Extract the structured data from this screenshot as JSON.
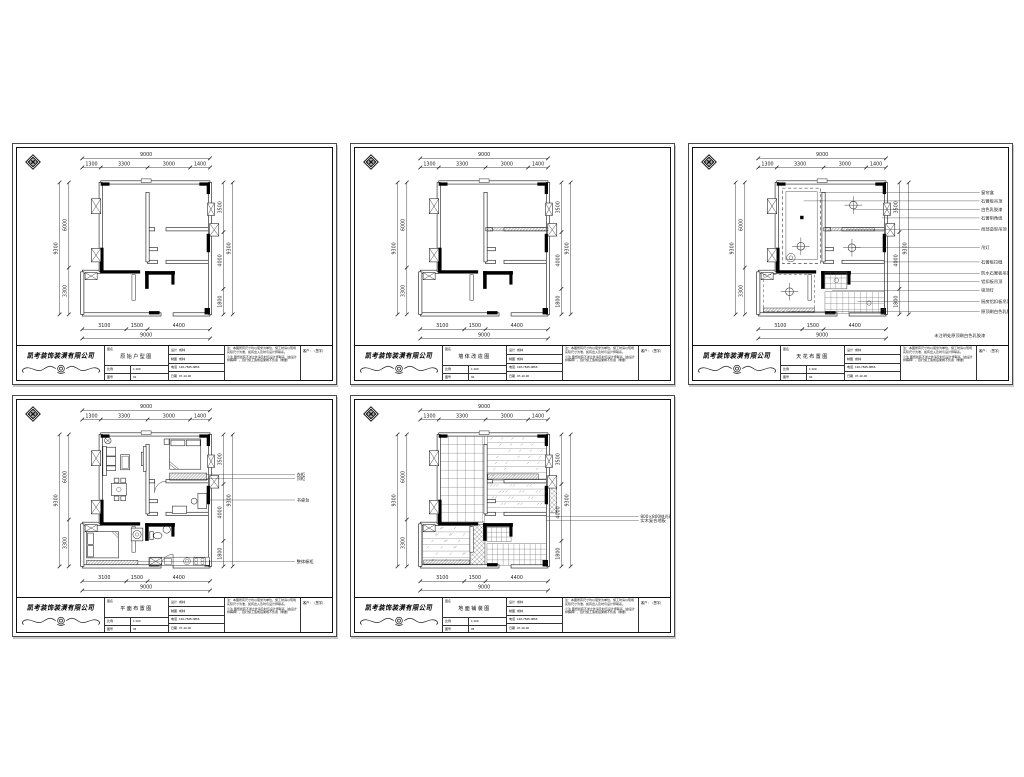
{
  "page": {
    "background": "#ffffff",
    "sheet_count": 5
  },
  "company": {
    "name": "凯考装饰装潢有限公司"
  },
  "sheet_titles": [
    "原始户型图",
    "墙体改造图",
    "天花布置图",
    "平面布置图",
    "地面铺装图"
  ],
  "title_block": {
    "drawing_label": "图名",
    "scale_label": "比例",
    "scale_value": "1:100",
    "no_label": "图号",
    "no_values": [
      "01",
      "02",
      "03",
      "04",
      "05"
    ],
    "fields": [
      {
        "label": "设计",
        "value": "成林"
      },
      {
        "label": "制图",
        "value": "成林"
      },
      {
        "label": "电话",
        "value": "130-7845-0866"
      },
      {
        "label": "日期",
        "value": "07-10-30"
      }
    ],
    "notes": [
      "注：本图所有尺寸均以毫米为单位，施工时请以现场实际尺寸为准，如有出入及时与设计师联系。",
      "※注 图纸如有不详之处请及时与设计师联系（由设计师解释），自行施工造成后果概不负责（重要）"
    ],
    "sign_label": "客户：（签字）"
  },
  "plan_dims": {
    "top": {
      "total": "9000",
      "segs": [
        [
          "1300",
          0,
          1300
        ],
        [
          "3300",
          1300,
          4600
        ],
        [
          "3000",
          4600,
          7600
        ],
        [
          "1400",
          7600,
          9000
        ]
      ]
    },
    "bottom": {
      "total": "9000",
      "segs": [
        [
          "3100",
          0,
          3100
        ],
        [
          "1500",
          3100,
          4600
        ],
        [
          "4400",
          4600,
          9000
        ]
      ]
    },
    "left": {
      "total": "9300",
      "segs": [
        [
          "6000",
          0,
          6000
        ],
        [
          "3300",
          6000,
          9300
        ]
      ]
    },
    "right": {
      "total": "9300",
      "segs": [
        [
          "3500",
          0,
          3500
        ],
        [
          "4000",
          3500,
          7500
        ],
        [
          "1800",
          7500,
          9300
        ]
      ]
    }
  },
  "leaders": {
    "ceiling": [
      [
        4300,
        700,
        "窗帘盒"
      ],
      [
        3200,
        1300,
        "石膏板吊顶"
      ],
      [
        6700,
        1900,
        "白色乳胶漆"
      ],
      [
        8700,
        2500,
        "石膏阴角线"
      ],
      [
        6200,
        3300,
        "局部造型吊顶"
      ],
      [
        6600,
        4600,
        "吊灯"
      ],
      [
        8800,
        5600,
        "石膏板拉缝"
      ],
      [
        5500,
        6400,
        "防水石膏板吊顶"
      ],
      [
        6300,
        7000,
        "铝扣板吊顶"
      ],
      [
        5200,
        7600,
        "吸顶灯"
      ],
      [
        7000,
        8400,
        "厨房铝扣板吊顶"
      ],
      [
        2200,
        9100,
        "原顶刷白色乳胶漆"
      ]
    ],
    "furniture": [
      [
        8700,
        2820,
        "衣柜"
      ],
      [
        8700,
        3120,
        "顶柜"
      ],
      [
        8900,
        4620,
        "书桌台"
      ],
      [
        3900,
        8950,
        "整体橱柜"
      ]
    ],
    "floor": [
      [
        8900,
        5780,
        "800×800抛光砖"
      ],
      [
        8900,
        6080,
        "实木复合地板"
      ]
    ]
  },
  "ceiling_note": "未注明处原顶刷白色乳胶漆",
  "colors": {
    "line": "#222222",
    "wall_fill": "#000000",
    "paper": "#ffffff"
  }
}
